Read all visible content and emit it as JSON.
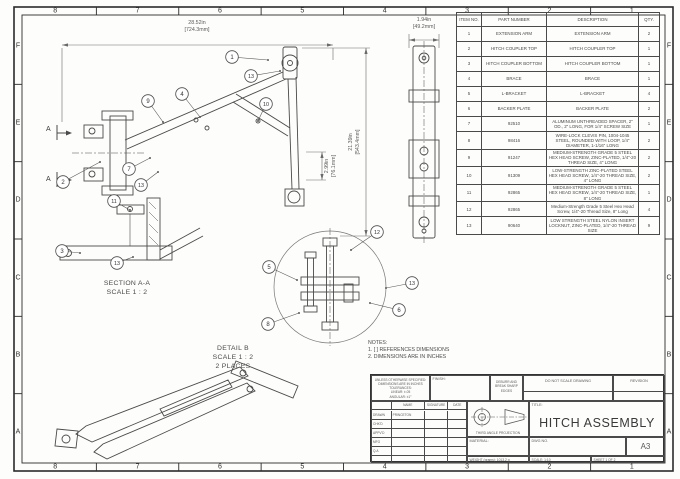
{
  "sheet": {
    "grid_columns": [
      "8",
      "7",
      "6",
      "5",
      "4",
      "3",
      "2",
      "1"
    ],
    "grid_rows": [
      "F",
      "E",
      "D",
      "C",
      "B",
      "A"
    ]
  },
  "bom": {
    "headers": [
      "ITEM NO.",
      "PART NUMBER",
      "DESCRIPTION",
      "QTY."
    ],
    "rows": [
      {
        "item": "1",
        "part": "EXTENSION ARM",
        "desc": "EXTENSION ARM",
        "qty": "2"
      },
      {
        "item": "2",
        "part": "HITCH COUPLER TOP",
        "desc": "HITCH COUPLER TOP",
        "qty": "1"
      },
      {
        "item": "3",
        "part": "HITCH COUPLER BOTTOM",
        "desc": "HITCH COUPLER BOTTOM",
        "qty": "1"
      },
      {
        "item": "4",
        "part": "BRACE",
        "desc": "BRACE",
        "qty": "1"
      },
      {
        "item": "5",
        "part": "L-BRACKET",
        "desc": "L-BRACKET",
        "qty": "4"
      },
      {
        "item": "6",
        "part": "BACKER PLATE",
        "desc": "BACKER PLATE",
        "qty": "2"
      },
      {
        "item": "7",
        "part": "92510",
        "desc": "ALUMINUM UNTHREADED SPACER, 2\" OD., 2\" LONG, FOR 1/4\" SCREW SIZE",
        "qty": "1"
      },
      {
        "item": "8",
        "part": "98416",
        "desc": "WIRE-LOCK CLEVIS PIN, 1004-1045 STEEL, ROUNDED WITH LOOP, 1/4\" DIAMETER, 1-1/16\" LONG",
        "qty": "2"
      },
      {
        "item": "9",
        "part": "91247",
        "desc": "MEDIUM-STRENGTH GRADE 5 STEEL HEX HEAD SCREW, ZINC-PLATED, 1/4\"-20 THREAD SIZE, 4\" LONG",
        "qty": "2"
      },
      {
        "item": "10",
        "part": "91309",
        "desc": "LOW-STRENGTH ZINC-PLATED STEEL HEX HEAD SCREW, 1/4\"-20 THREAD SIZE, 4\" LONG",
        "qty": "2"
      },
      {
        "item": "11",
        "part": "92865",
        "desc": "MEDIUM-STRENGTH GRADE 5 STEEL HEX HEAD SCREW, 1/4\"-20 THREAD SIZE, 8\" LONG",
        "qty": "1"
      },
      {
        "item": "12",
        "part": "92865",
        "desc": "Medium-Strength Grade 5 Steel Hex Head Screw, 1/4\"-20 Thread Size, 8\" Long",
        "qty": "4"
      },
      {
        "item": "13",
        "part": "90640",
        "desc": "LOW STRENGTH STEEL NYLON INSERT LOCKNUT, ZINC-PLATED, 1/4\"-20 THREAD SIZE",
        "qty": "9"
      }
    ]
  },
  "dimensions": {
    "overall_width": {
      "in": "28.52in",
      "mm": "[724.3mm]"
    },
    "side_width": {
      "in": "1.94in",
      "mm": "[49.2mm]"
    },
    "overall_height": {
      "in": "21.39in",
      "mm": "[543.4mm]"
    },
    "hub_height": {
      "in": "2.99in",
      "mm": "[76.1mm]"
    }
  },
  "labels": {
    "section": "SECTION A-A",
    "section_scale": "SCALE 1 : 2",
    "detail": "DETAIL B",
    "detail_scale": "SCALE 1 : 2",
    "detail_places": "2 PLACES",
    "notes_title": "NOTES:",
    "note1": "1. [ ] REFERENCES DIMENSIONS",
    "note2": "2. DIMENSIONS ARE IN INCHES",
    "section_marker": "A"
  },
  "balloons": [
    {
      "n": "1",
      "x": 232,
      "y": 57,
      "tx": 268,
      "ty": 60
    },
    {
      "n": "13",
      "x": 251,
      "y": 76,
      "tx": 280,
      "ty": 71
    },
    {
      "n": "9",
      "x": 148,
      "y": 101,
      "tx": 163,
      "ty": 122
    },
    {
      "n": "4",
      "x": 182,
      "y": 94,
      "tx": 200,
      "ty": 117
    },
    {
      "n": "10",
      "x": 266,
      "y": 104,
      "tx": 258,
      "ty": 121
    },
    {
      "n": "2",
      "x": 63,
      "y": 182,
      "tx": 100,
      "ty": 162
    },
    {
      "n": "7",
      "x": 129,
      "y": 169,
      "tx": 150,
      "ty": 158
    },
    {
      "n": "13",
      "x": 141,
      "y": 185,
      "tx": 158,
      "ty": 172
    },
    {
      "n": "11",
      "x": 114,
      "y": 201,
      "tx": 130,
      "ty": 210
    },
    {
      "n": "3",
      "x": 62,
      "y": 251,
      "tx": 80,
      "ty": 253
    },
    {
      "n": "13",
      "x": 117,
      "y": 263,
      "tx": 133,
      "ty": 257
    },
    {
      "n": "12",
      "x": 377,
      "y": 232,
      "tx": 351,
      "ty": 250
    },
    {
      "n": "13",
      "x": 412,
      "y": 283,
      "tx": 386,
      "ty": 288
    },
    {
      "n": "6",
      "x": 399,
      "y": 310,
      "tx": 370,
      "ty": 303
    },
    {
      "n": "5",
      "x": 269,
      "y": 267,
      "tx": 297,
      "ty": 280
    },
    {
      "n": "8",
      "x": 268,
      "y": 324,
      "tx": 299,
      "ty": 313
    }
  ],
  "title_block": {
    "tolerance_lines": [
      "UNLESS OTHERWISE SPECIFIED:",
      "DIMENSIONS ARE IN INCHES",
      "TOLERANCES:",
      "LINEAR: ±.05",
      "ANGULAR: ±1°"
    ],
    "finish_label": "FINISH:",
    "deburr": "DEBURR AND BREAK SHARP EDGES",
    "do_not_scale": "DO NOT SCALE DRAWING",
    "revision_label": "REVISION",
    "name_header": "NAME",
    "signature_header": "SIGNATURE",
    "date_header": "DATE",
    "rows": [
      {
        "label": "DRAWN",
        "name": "PRINCETON"
      },
      {
        "label": "CHK'D",
        "name": ""
      },
      {
        "label": "APPV'D",
        "name": ""
      },
      {
        "label": "MFG",
        "name": ""
      },
      {
        "label": "Q.A",
        "name": ""
      }
    ],
    "projection_label": "THIRD ANGLE PROJECTION",
    "title_label": "TITLE:",
    "title": "HITCH ASSEMBLY",
    "material_label": "MATERIAL:",
    "dwg_no_label": "DWG NO.",
    "paper_size": "A3",
    "weight": "WEIGHT (grams): 1013.2 g",
    "scale": "SCALE: 1:10",
    "sheet": "SHEET 1 OF 2"
  }
}
